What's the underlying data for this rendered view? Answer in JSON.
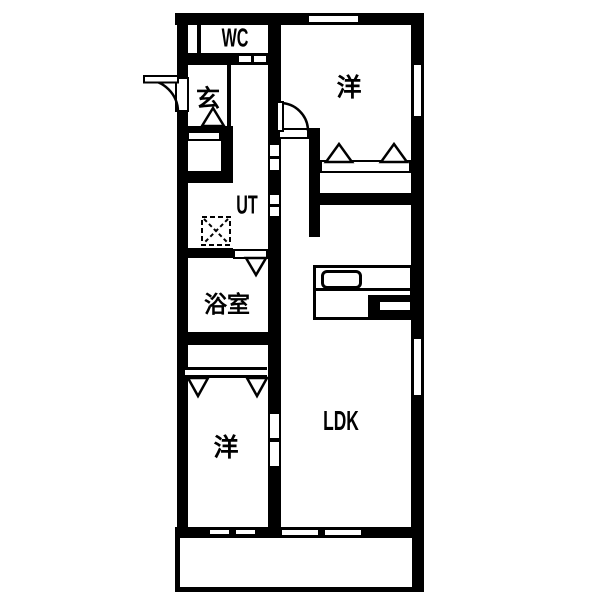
{
  "floorplan": {
    "type": "apartment-floor-plan",
    "rooms": {
      "wc": {
        "label": "WC"
      },
      "genkan": {
        "label": "玄"
      },
      "bedroom_top": {
        "label": "洋"
      },
      "ut": {
        "label": "UT"
      },
      "bathroom": {
        "label": "浴室"
      },
      "bedroom_bottom": {
        "label": "洋"
      },
      "ldk": {
        "label": "LDK"
      }
    },
    "colors": {
      "wall": "#000000",
      "floor": "#ffffff"
    }
  }
}
